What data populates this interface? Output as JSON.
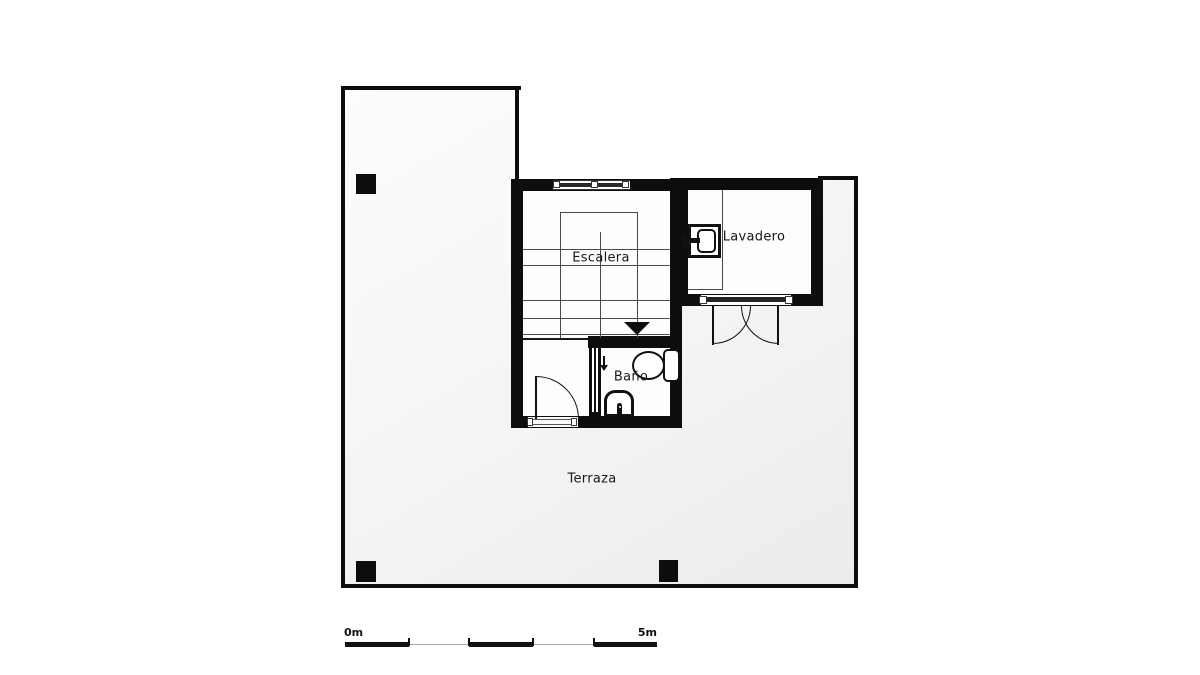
{
  "rooms": {
    "escalera": {
      "label": "Escalera"
    },
    "lavadero": {
      "label": "Lavadero"
    },
    "bano": {
      "label": "Baño"
    },
    "terraza": {
      "label": "Terraza"
    }
  },
  "scale_bar": {
    "start": "0m",
    "end": "5m"
  },
  "icons": [
    "stair-direction-arrow-icon",
    "window-icon",
    "washing-machine-icon",
    "toilet-icon",
    "sink-icon",
    "door-swing-icon",
    "double-door-swing-icon",
    "entry-arrow-icon",
    "column-marker"
  ],
  "colors": {
    "wall": "#0d0d0d",
    "room_fill": "#fdfdfd",
    "terrace_fill": "#ebebeb",
    "stair_line": "#4a4a4a",
    "label_text": "#191919",
    "background": "#ffffff"
  }
}
